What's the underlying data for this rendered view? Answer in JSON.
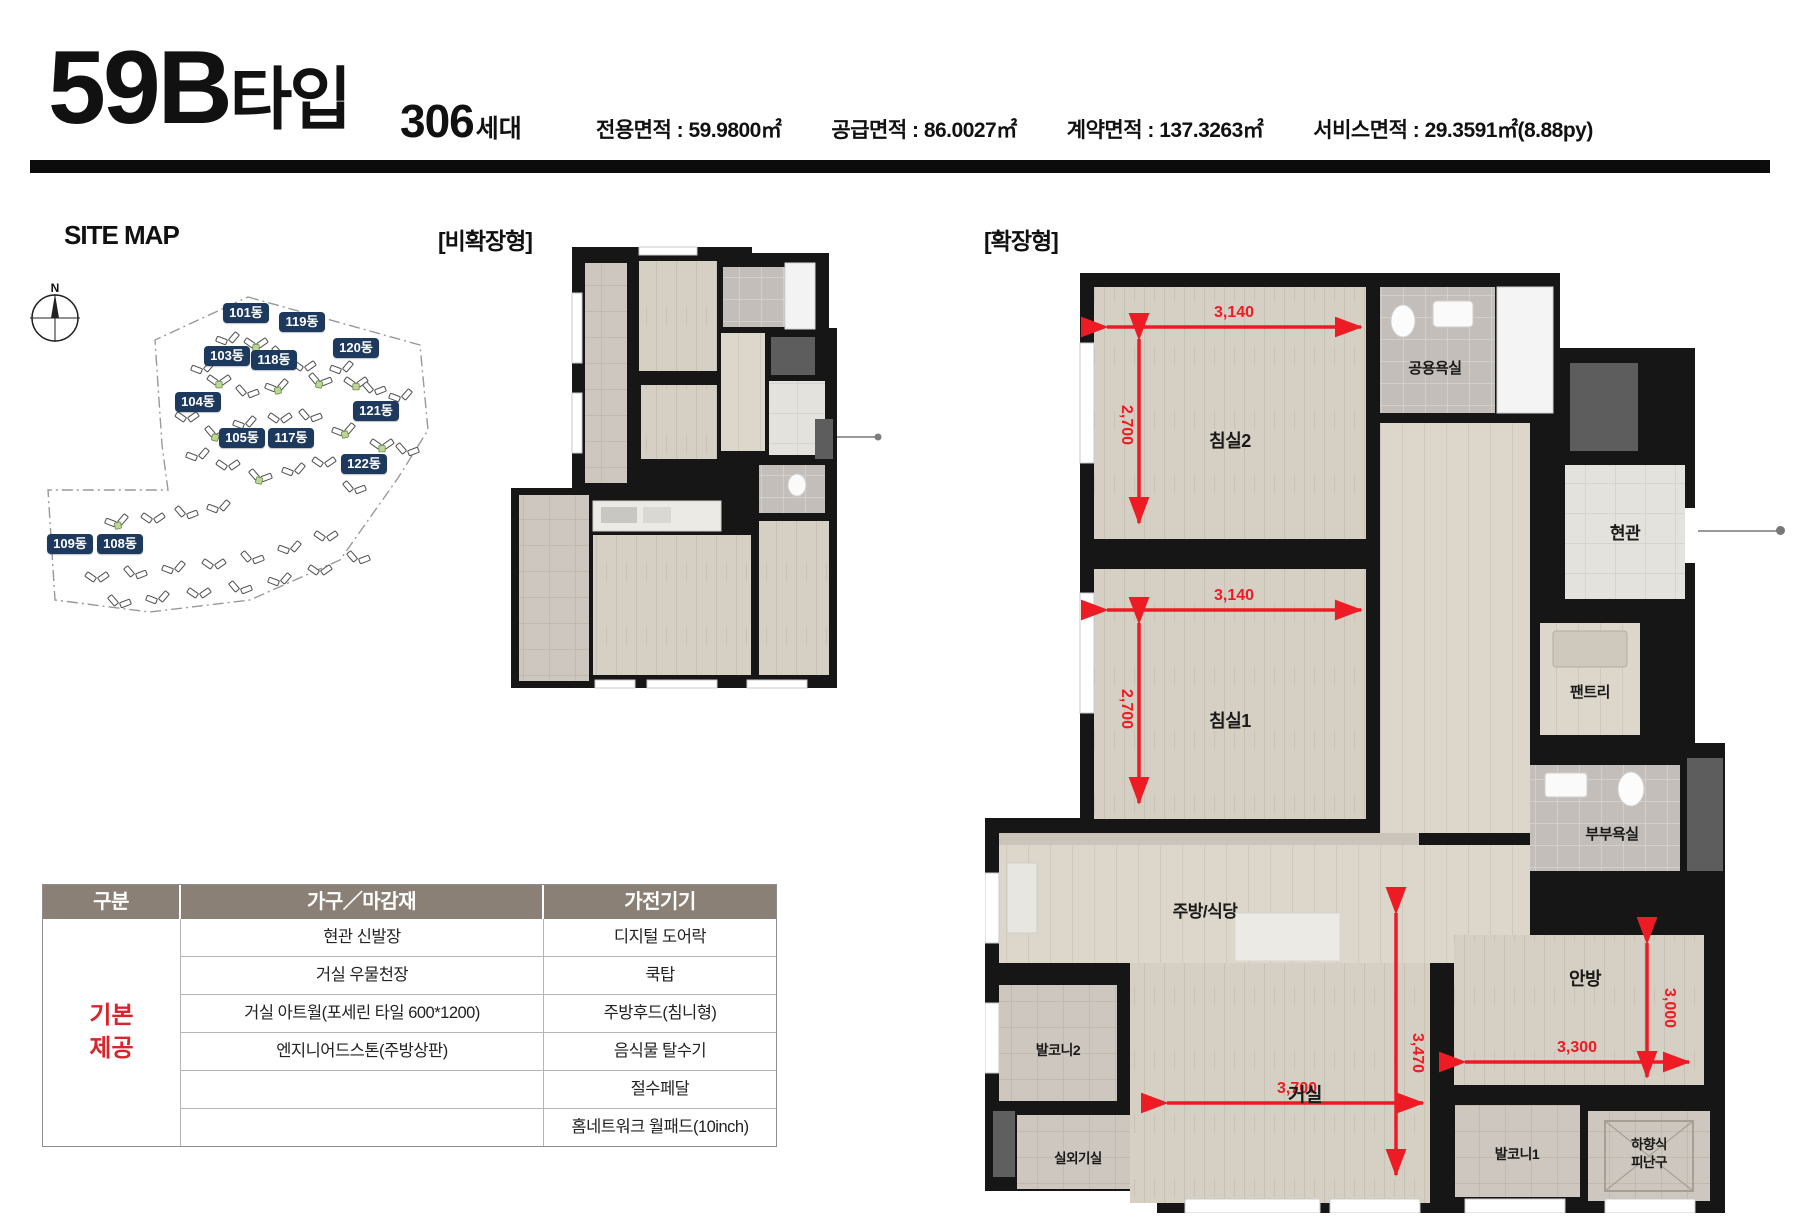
{
  "header": {
    "type_name": "59B",
    "type_suffix": "타입",
    "units_count": "306",
    "units_suffix": "세대",
    "areas": [
      {
        "label": "전용면적",
        "value": "59.9800㎡"
      },
      {
        "label": "공급면적",
        "value": "86.0027㎡"
      },
      {
        "label": "계약면적",
        "value": "137.3263㎡"
      },
      {
        "label": "서비스면적",
        "value": "29.3591㎡(8.88py)"
      }
    ]
  },
  "site_map": {
    "title": "SITE MAP",
    "compass_label": "N",
    "buildings": [
      {
        "label": "101동",
        "x": 183,
        "y": 63
      },
      {
        "label": "119동",
        "x": 239,
        "y": 72
      },
      {
        "label": "120동",
        "x": 293,
        "y": 98
      },
      {
        "label": "103동",
        "x": 164,
        "y": 106
      },
      {
        "label": "118동",
        "x": 211,
        "y": 110
      },
      {
        "label": "104동",
        "x": 135,
        "y": 152
      },
      {
        "label": "121동",
        "x": 313,
        "y": 161
      },
      {
        "label": "105동",
        "x": 179,
        "y": 188
      },
      {
        "label": "117동",
        "x": 228,
        "y": 188
      },
      {
        "label": "122동",
        "x": 301,
        "y": 214
      },
      {
        "label": "109동",
        "x": 7,
        "y": 294
      },
      {
        "label": "108동",
        "x": 57,
        "y": 294
      }
    ]
  },
  "plans": {
    "non_expanded_label": "[비확장형]",
    "expanded_label": "[확장형]",
    "expanded_rooms": {
      "bedroom2": "침실2",
      "common_bath": "공용욕실",
      "entrance": "현관",
      "bedroom1": "침실1",
      "pantry": "팬트리",
      "master_bath": "부부욕실",
      "kitchen": "주방/식당",
      "balcony2": "발코니2",
      "living": "거실",
      "outdoor_unit": "실외기실",
      "master_bedroom": "안방",
      "balcony1": "발코니1",
      "escape_hatch_line1": "하향식",
      "escape_hatch_line2": "피난구"
    },
    "expanded_dims": {
      "bedroom2_w": "3,140",
      "bedroom2_h": "2,700",
      "bedroom1_w": "3,140",
      "bedroom1_h": "2,700",
      "living_w": "3,700",
      "living_h": "3,470",
      "master_w": "3,300",
      "master_h": "3,000"
    }
  },
  "table": {
    "headers": [
      "구분",
      "가구／마감재",
      "가전기기"
    ],
    "group_label_line1": "기본",
    "group_label_line2": "제공",
    "rows": [
      {
        "furniture": "현관 신발장",
        "appliance": "디지털 도어락"
      },
      {
        "furniture": "거실 우물천장",
        "appliance": "쿡탑"
      },
      {
        "furniture": "거실 아트월(포세린 타일 600*1200)",
        "appliance": "주방후드(침니형)"
      },
      {
        "furniture": "엔지니어드스톤(주방상판)",
        "appliance": "음식물 탈수기"
      },
      {
        "furniture": "",
        "appliance": "절수페달"
      },
      {
        "furniture": "",
        "appliance": "홈네트워크 월패드(10inch)"
      }
    ]
  },
  "colors": {
    "accent_navy": "#1d3a5e",
    "dimension_red": "#ed1c24",
    "group_label_red": "#d8242a",
    "table_header_bg": "#8a8076",
    "wall_black": "#161616",
    "floor_beige": "#d6cfc4",
    "tile_gray": "#c3beba"
  }
}
